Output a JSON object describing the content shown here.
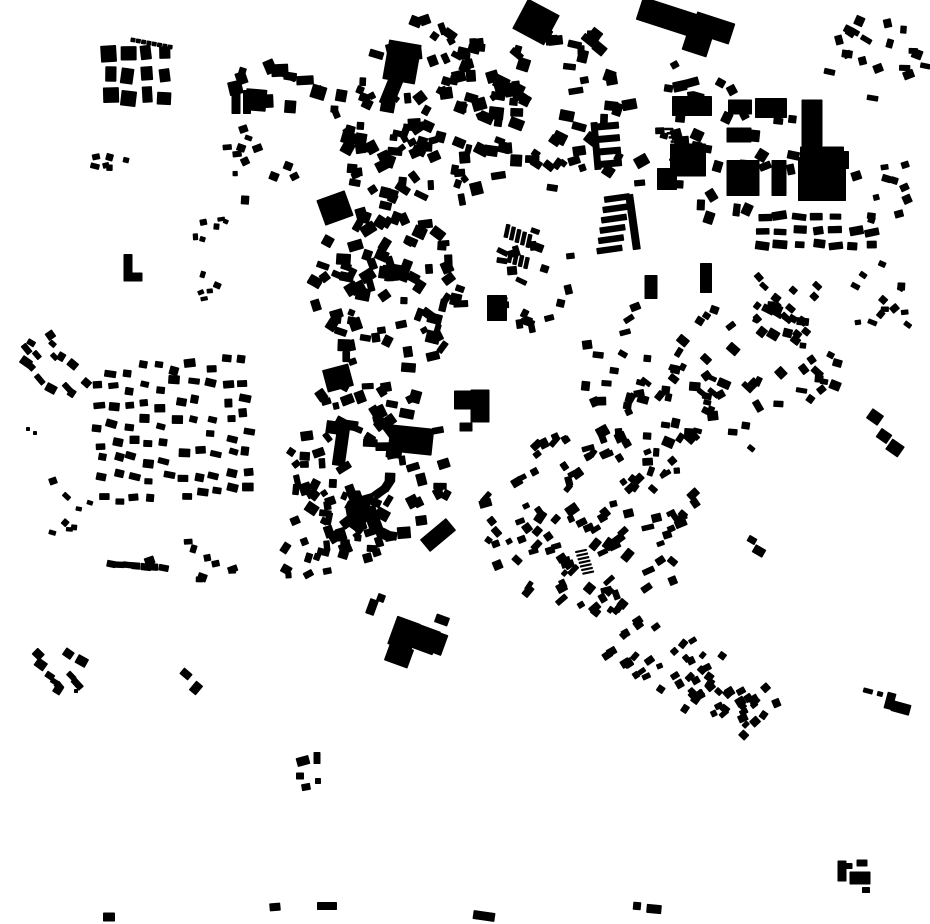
{
  "map": {
    "description": "Black and white figure-ground map of building footprints (no labels, no text, monochrome city block pattern)",
    "canvas": {
      "width": 930,
      "height": 924,
      "background": "#ffffff",
      "building_color": "#000000"
    },
    "rect_format": "cx, cy, w, h, rotation_deg",
    "landmarks": [
      [
        402,
        62,
        33,
        40,
        10
      ],
      [
        391,
        92,
        15,
        28,
        22
      ],
      [
        335,
        208,
        30,
        27,
        -20
      ],
      [
        338,
        378,
        27,
        23,
        -15
      ],
      [
        256,
        100,
        21,
        22,
        5
      ],
      [
        236,
        100,
        9,
        28,
        0
      ],
      [
        247,
        102,
        8,
        24,
        0
      ],
      [
        471,
        400,
        34,
        19,
        0
      ],
      [
        480,
        406,
        19,
        33,
        0
      ],
      [
        466,
        427,
        13,
        9,
        0
      ],
      [
        812,
        123,
        21,
        47,
        0
      ],
      [
        822,
        152,
        44,
        11,
        0
      ],
      [
        822,
        179,
        48,
        44,
        0
      ],
      [
        843,
        160,
        12,
        18,
        0
      ],
      [
        667,
        17,
        58,
        24,
        18
      ],
      [
        713,
        28,
        40,
        22,
        18
      ],
      [
        697,
        44,
        26,
        20,
        18
      ],
      [
        536,
        22,
        36,
        34,
        28
      ],
      [
        692,
        106,
        40,
        20,
        0
      ],
      [
        740,
        107,
        24,
        15,
        0
      ],
      [
        771,
        108,
        32,
        20,
        0
      ],
      [
        688,
        160,
        36,
        33,
        0
      ],
      [
        739,
        135,
        25,
        15,
        0
      ],
      [
        743,
        178,
        33,
        36,
        0
      ],
      [
        779,
        178,
        15,
        36,
        0
      ],
      [
        667,
        179,
        20,
        22,
        0
      ],
      [
        651,
        287,
        13,
        24,
        0
      ],
      [
        706,
        278,
        12,
        30,
        0
      ],
      [
        497,
        308,
        20,
        26,
        0
      ],
      [
        341,
        446,
        13,
        40,
        8
      ],
      [
        337,
        428,
        22,
        13,
        8
      ],
      [
        411,
        440,
        44,
        27,
        6
      ],
      [
        394,
        452,
        16,
        12,
        6
      ],
      [
        438,
        535,
        34,
        16,
        -40
      ],
      [
        404,
        634,
        25,
        30,
        20
      ],
      [
        424,
        639,
        27,
        25,
        20
      ],
      [
        399,
        655,
        25,
        20,
        20
      ],
      [
        440,
        644,
        10,
        22,
        20
      ],
      [
        442,
        620,
        14,
        9,
        20
      ],
      [
        372,
        607,
        9,
        16,
        20
      ],
      [
        381,
        598,
        8,
        8,
        20
      ],
      [
        128,
        267,
        9,
        26,
        0
      ],
      [
        133,
        277,
        19,
        9,
        0
      ],
      [
        633,
        222,
        8,
        56,
        -8
      ],
      [
        596,
        146,
        7,
        48,
        -5
      ],
      [
        875,
        417,
        14,
        12,
        35
      ],
      [
        884,
        436,
        13,
        11,
        35
      ],
      [
        895,
        448,
        15,
        13,
        35
      ],
      [
        752,
        540,
        9,
        7,
        30
      ],
      [
        759,
        551,
        12,
        9,
        30
      ],
      [
        890,
        701,
        9,
        17,
        15
      ],
      [
        901,
        708,
        19,
        11,
        15
      ],
      [
        868,
        691,
        10,
        5,
        15
      ],
      [
        880,
        694,
        6,
        5,
        15
      ],
      [
        842,
        871,
        9,
        21,
        0
      ],
      [
        862,
        863,
        11,
        7,
        0
      ],
      [
        860,
        878,
        21,
        13,
        0
      ],
      [
        866,
        890,
        8,
        6,
        0
      ],
      [
        849,
        866,
        7,
        6,
        0
      ],
      [
        637,
        906,
        8,
        8,
        5
      ],
      [
        654,
        909,
        15,
        9,
        5
      ],
      [
        109,
        917,
        12,
        9,
        0
      ],
      [
        275,
        907,
        11,
        8,
        -5
      ],
      [
        327,
        906,
        20,
        8,
        0
      ],
      [
        484,
        916,
        22,
        9,
        8
      ],
      [
        303,
        761,
        13,
        9,
        -15
      ],
      [
        317,
        758,
        7,
        12,
        0
      ],
      [
        300,
        776,
        8,
        7,
        0
      ],
      [
        306,
        787,
        9,
        7,
        -10
      ],
      [
        318,
        781,
        6,
        6,
        0
      ],
      [
        186,
        674,
        11,
        8,
        40
      ],
      [
        196,
        688,
        9,
        12,
        40
      ],
      [
        76,
        691,
        4,
        4,
        0
      ],
      [
        53,
        481,
        8,
        7,
        -20
      ],
      [
        28,
        429,
        4,
        4,
        0
      ],
      [
        35,
        433,
        4,
        4,
        0
      ]
    ],
    "combs": [
      {
        "x": 617,
        "y": 198,
        "n": 6,
        "dx": -1.5,
        "dy": 10.3,
        "w": 26,
        "h": 6.5,
        "rot": -8
      },
      {
        "x": 608,
        "y": 126,
        "n": 4,
        "dx": 1,
        "dy": 12.5,
        "w": 22,
        "h": 7,
        "rot": -5
      },
      {
        "x": 354,
        "y": 500,
        "n": 4,
        "dx": 7.3,
        "dy": 7,
        "w": 9,
        "h": 32,
        "rot": -20
      },
      {
        "x": 581,
        "y": 551,
        "n": 7,
        "dx": 1.2,
        "dy": 3.6,
        "w": 12,
        "h": 2.2,
        "rot": -12
      },
      {
        "x": 133,
        "y": 40,
        "n": 8,
        "dx": 5.3,
        "dy": 1,
        "w": 5,
        "h": 4.5,
        "rot": 8
      },
      {
        "x": 507,
        "y": 231,
        "n": 5,
        "dx": 5.5,
        "dy": 2.5,
        "w": 4.5,
        "h": 14,
        "rot": 12
      },
      {
        "x": 510,
        "y": 257,
        "n": 4,
        "dx": 5.5,
        "dy": 2,
        "w": 4.5,
        "h": 12,
        "rot": 12
      },
      {
        "x": 669,
        "y": 129,
        "n": 5,
        "dx": 2,
        "dy": 4.2,
        "w": 9,
        "h": 2.5,
        "rot": 0
      }
    ],
    "clusters": [
      {
        "id": "top-left-grid",
        "mode": "rows",
        "rows": 3,
        "cx": 137,
        "cy": 75,
        "rx": 36,
        "ry": 32,
        "tilt": 0,
        "count": 12,
        "w": [
          10,
          16
        ],
        "h": [
          12,
          17
        ],
        "rot": [
          0,
          8
        ],
        "seed": 1
      },
      {
        "id": "north-west-block",
        "mode": "scatter",
        "cx": 278,
        "cy": 78,
        "rx": 46,
        "ry": 34,
        "tilt": 0,
        "count": 14,
        "w": [
          7,
          18
        ],
        "h": [
          7,
          14
        ],
        "rot": [
          0,
          25
        ],
        "seed": 2
      },
      {
        "id": "core-north",
        "mode": "scatter",
        "cx": 424,
        "cy": 120,
        "rx": 92,
        "ry": 102,
        "tilt": 0,
        "count": 115,
        "w": [
          6,
          15
        ],
        "h": [
          6,
          13
        ],
        "rot": [
          0,
          38
        ],
        "seed": 3
      },
      {
        "id": "core-mid",
        "mode": "scatter",
        "cx": 388,
        "cy": 290,
        "rx": 74,
        "ry": 86,
        "tilt": 0,
        "count": 85,
        "w": [
          6,
          15
        ],
        "h": [
          6,
          13
        ],
        "rot": [
          0,
          38
        ],
        "seed": 4
      },
      {
        "id": "core-south",
        "mode": "scatter",
        "cx": 372,
        "cy": 462,
        "rx": 82,
        "ry": 86,
        "tilt": 0,
        "count": 85,
        "w": [
          6,
          15
        ],
        "h": [
          6,
          13
        ],
        "rot": [
          0,
          38
        ],
        "seed": 5
      },
      {
        "id": "core-south2",
        "mode": "scatter",
        "cx": 330,
        "cy": 548,
        "rx": 58,
        "ry": 42,
        "tilt": 0,
        "count": 26,
        "w": [
          6,
          13
        ],
        "h": [
          6,
          11
        ],
        "rot": [
          0,
          38
        ],
        "seed": 6
      },
      {
        "id": "top-mid-east",
        "mode": "scatter",
        "cx": 560,
        "cy": 112,
        "rx": 68,
        "ry": 92,
        "tilt": 0,
        "count": 55,
        "w": [
          7,
          15
        ],
        "h": [
          6,
          13
        ],
        "rot": [
          10,
          30
        ],
        "seed": 7
      },
      {
        "id": "industrial-ne",
        "mode": "scatter",
        "cx": 706,
        "cy": 140,
        "rx": 92,
        "ry": 82,
        "tilt": 0,
        "count": 40,
        "w": [
          7,
          16
        ],
        "h": [
          6,
          13
        ],
        "rot": [
          0,
          32
        ],
        "seed": 8
      },
      {
        "id": "ne-corner",
        "mode": "scatter",
        "cx": 876,
        "cy": 60,
        "rx": 52,
        "ry": 46,
        "tilt": 0,
        "count": 20,
        "w": [
          6,
          12
        ],
        "h": [
          5,
          10
        ],
        "rot": [
          0,
          35
        ],
        "seed": 9
      },
      {
        "id": "right-strip",
        "mode": "rows",
        "rows": 3,
        "cx": 818,
        "cy": 231,
        "rx": 64,
        "ry": 21,
        "tilt": 0,
        "count": 20,
        "w": [
          8,
          15
        ],
        "h": [
          6,
          9
        ],
        "rot": [
          0,
          12
        ],
        "seed": 10
      },
      {
        "id": "right-diag-trail",
        "mode": "scatter",
        "cx": 786,
        "cy": 302,
        "rx": 52,
        "ry": 36,
        "tilt": 35,
        "count": 15,
        "w": [
          6,
          10
        ],
        "h": [
          5,
          8
        ],
        "rot": [
          40,
          12
        ],
        "seed": 11
      },
      {
        "id": "far-right-sparse",
        "mode": "scatter",
        "cx": 888,
        "cy": 185,
        "rx": 40,
        "ry": 58,
        "tilt": 0,
        "count": 10,
        "w": [
          6,
          11
        ],
        "h": [
          5,
          9
        ],
        "rot": [
          0,
          35
        ],
        "seed": 12
      },
      {
        "id": "right-band2",
        "mode": "scatter",
        "cx": 880,
        "cy": 298,
        "rx": 46,
        "ry": 42,
        "tilt": 0,
        "count": 13,
        "w": [
          6,
          11
        ],
        "h": [
          5,
          9
        ],
        "rot": [
          20,
          30
        ],
        "seed": 13
      },
      {
        "id": "east-mid",
        "mode": "scatter",
        "cx": 756,
        "cy": 372,
        "rx": 82,
        "ry": 80,
        "tilt": 0,
        "count": 50,
        "w": [
          6,
          13
        ],
        "h": [
          5,
          10
        ],
        "rot": [
          30,
          30
        ],
        "seed": 14
      },
      {
        "id": "east-mid2",
        "mode": "scatter",
        "cx": 668,
        "cy": 420,
        "rx": 52,
        "ry": 58,
        "tilt": 0,
        "count": 28,
        "w": [
          6,
          12
        ],
        "h": [
          5,
          10
        ],
        "rot": [
          20,
          30
        ],
        "seed": 15
      },
      {
        "id": "gap-cluster",
        "mode": "scatter",
        "cx": 617,
        "cy": 357,
        "rx": 45,
        "ry": 58,
        "tilt": 0,
        "count": 16,
        "w": [
          6,
          12
        ],
        "h": [
          5,
          10
        ],
        "rot": [
          0,
          35
        ],
        "seed": 16
      },
      {
        "id": "mid-east-small",
        "mode": "scatter",
        "cx": 537,
        "cy": 278,
        "rx": 42,
        "ry": 52,
        "tilt": 0,
        "count": 22,
        "w": [
          6,
          13
        ],
        "h": [
          5,
          11
        ],
        "rot": [
          10,
          30
        ],
        "seed": 17
      },
      {
        "id": "left-hamlet",
        "mode": "scatter",
        "cx": 60,
        "cy": 368,
        "rx": 46,
        "ry": 34,
        "tilt": 0,
        "count": 15,
        "w": [
          6,
          12
        ],
        "h": [
          5,
          9
        ],
        "rot": [
          40,
          15
        ],
        "seed": 18
      },
      {
        "id": "west-suburb",
        "mode": "rows",
        "rows": 8,
        "cx": 172,
        "cy": 430,
        "rx": 82,
        "ry": 72,
        "tilt": -4,
        "count": 78,
        "w": [
          8,
          12
        ],
        "h": [
          6,
          9
        ],
        "rot": [
          5,
          12
        ],
        "seed": 19
      },
      {
        "id": "left-bits",
        "mode": "scatter",
        "cx": 68,
        "cy": 512,
        "rx": 24,
        "ry": 36,
        "tilt": 0,
        "count": 7,
        "w": [
          5,
          9
        ],
        "h": [
          4,
          7
        ],
        "rot": [
          20,
          25
        ],
        "seed": 20
      },
      {
        "id": "row-560",
        "mode": "rows",
        "rows": 1,
        "cx": 137,
        "cy": 566,
        "rx": 30,
        "ry": 7,
        "tilt": 4,
        "count": 7,
        "w": [
          8,
          11
        ],
        "h": [
          6,
          8
        ],
        "rot": [
          5,
          8
        ],
        "seed": 21
      },
      {
        "id": "mid-left-sparse",
        "mode": "scatter",
        "cx": 196,
        "cy": 548,
        "rx": 52,
        "ry": 40,
        "tilt": 0,
        "count": 9,
        "w": [
          6,
          12
        ],
        "h": [
          5,
          9
        ],
        "rot": [
          10,
          30
        ],
        "seed": 22
      },
      {
        "id": "se-fan",
        "mode": "scatter",
        "cx": 592,
        "cy": 520,
        "rx": 112,
        "ry": 92,
        "tilt": 0,
        "count": 115,
        "w": [
          6,
          13
        ],
        "h": [
          5,
          10
        ],
        "rot": [
          -35,
          22
        ],
        "seed": 23
      },
      {
        "id": "se-tail",
        "mode": "scatter",
        "cx": 690,
        "cy": 676,
        "rx": 125,
        "ry": 35,
        "tilt": 28,
        "count": 62,
        "w": [
          6,
          10
        ],
        "h": [
          5,
          9
        ],
        "rot": [
          -40,
          18
        ],
        "seed": 24
      },
      {
        "id": "sw-hamlet",
        "mode": "scatter",
        "cx": 58,
        "cy": 672,
        "rx": 28,
        "ry": 27,
        "tilt": 0,
        "count": 10,
        "w": [
          6,
          13
        ],
        "h": [
          5,
          10
        ],
        "rot": [
          40,
          12
        ],
        "seed": 25
      },
      {
        "id": "nw-sparse",
        "mode": "scatter",
        "cx": 250,
        "cy": 168,
        "rx": 52,
        "ry": 42,
        "tilt": 0,
        "count": 12,
        "w": [
          5,
          10
        ],
        "h": [
          5,
          9
        ],
        "rot": [
          0,
          30
        ],
        "seed": 26
      },
      {
        "id": "nw-bits",
        "mode": "scatter",
        "cx": 111,
        "cy": 158,
        "rx": 24,
        "ry": 20,
        "tilt": 0,
        "count": 6,
        "w": [
          6,
          10
        ],
        "h": [
          5,
          8
        ],
        "rot": [
          0,
          20
        ],
        "seed": 27
      },
      {
        "id": "w-dots",
        "mode": "scatter",
        "cx": 208,
        "cy": 233,
        "rx": 26,
        "ry": 17,
        "tilt": 0,
        "count": 6,
        "w": [
          5,
          8
        ],
        "h": [
          4,
          7
        ],
        "rot": [
          0,
          25
        ],
        "seed": 28
      },
      {
        "id": "w-bits2",
        "mode": "scatter",
        "cx": 206,
        "cy": 285,
        "rx": 14,
        "ry": 16,
        "tilt": 0,
        "count": 5,
        "w": [
          5,
          9
        ],
        "h": [
          4,
          7
        ],
        "rot": [
          0,
          25
        ],
        "seed": 29
      }
    ]
  }
}
